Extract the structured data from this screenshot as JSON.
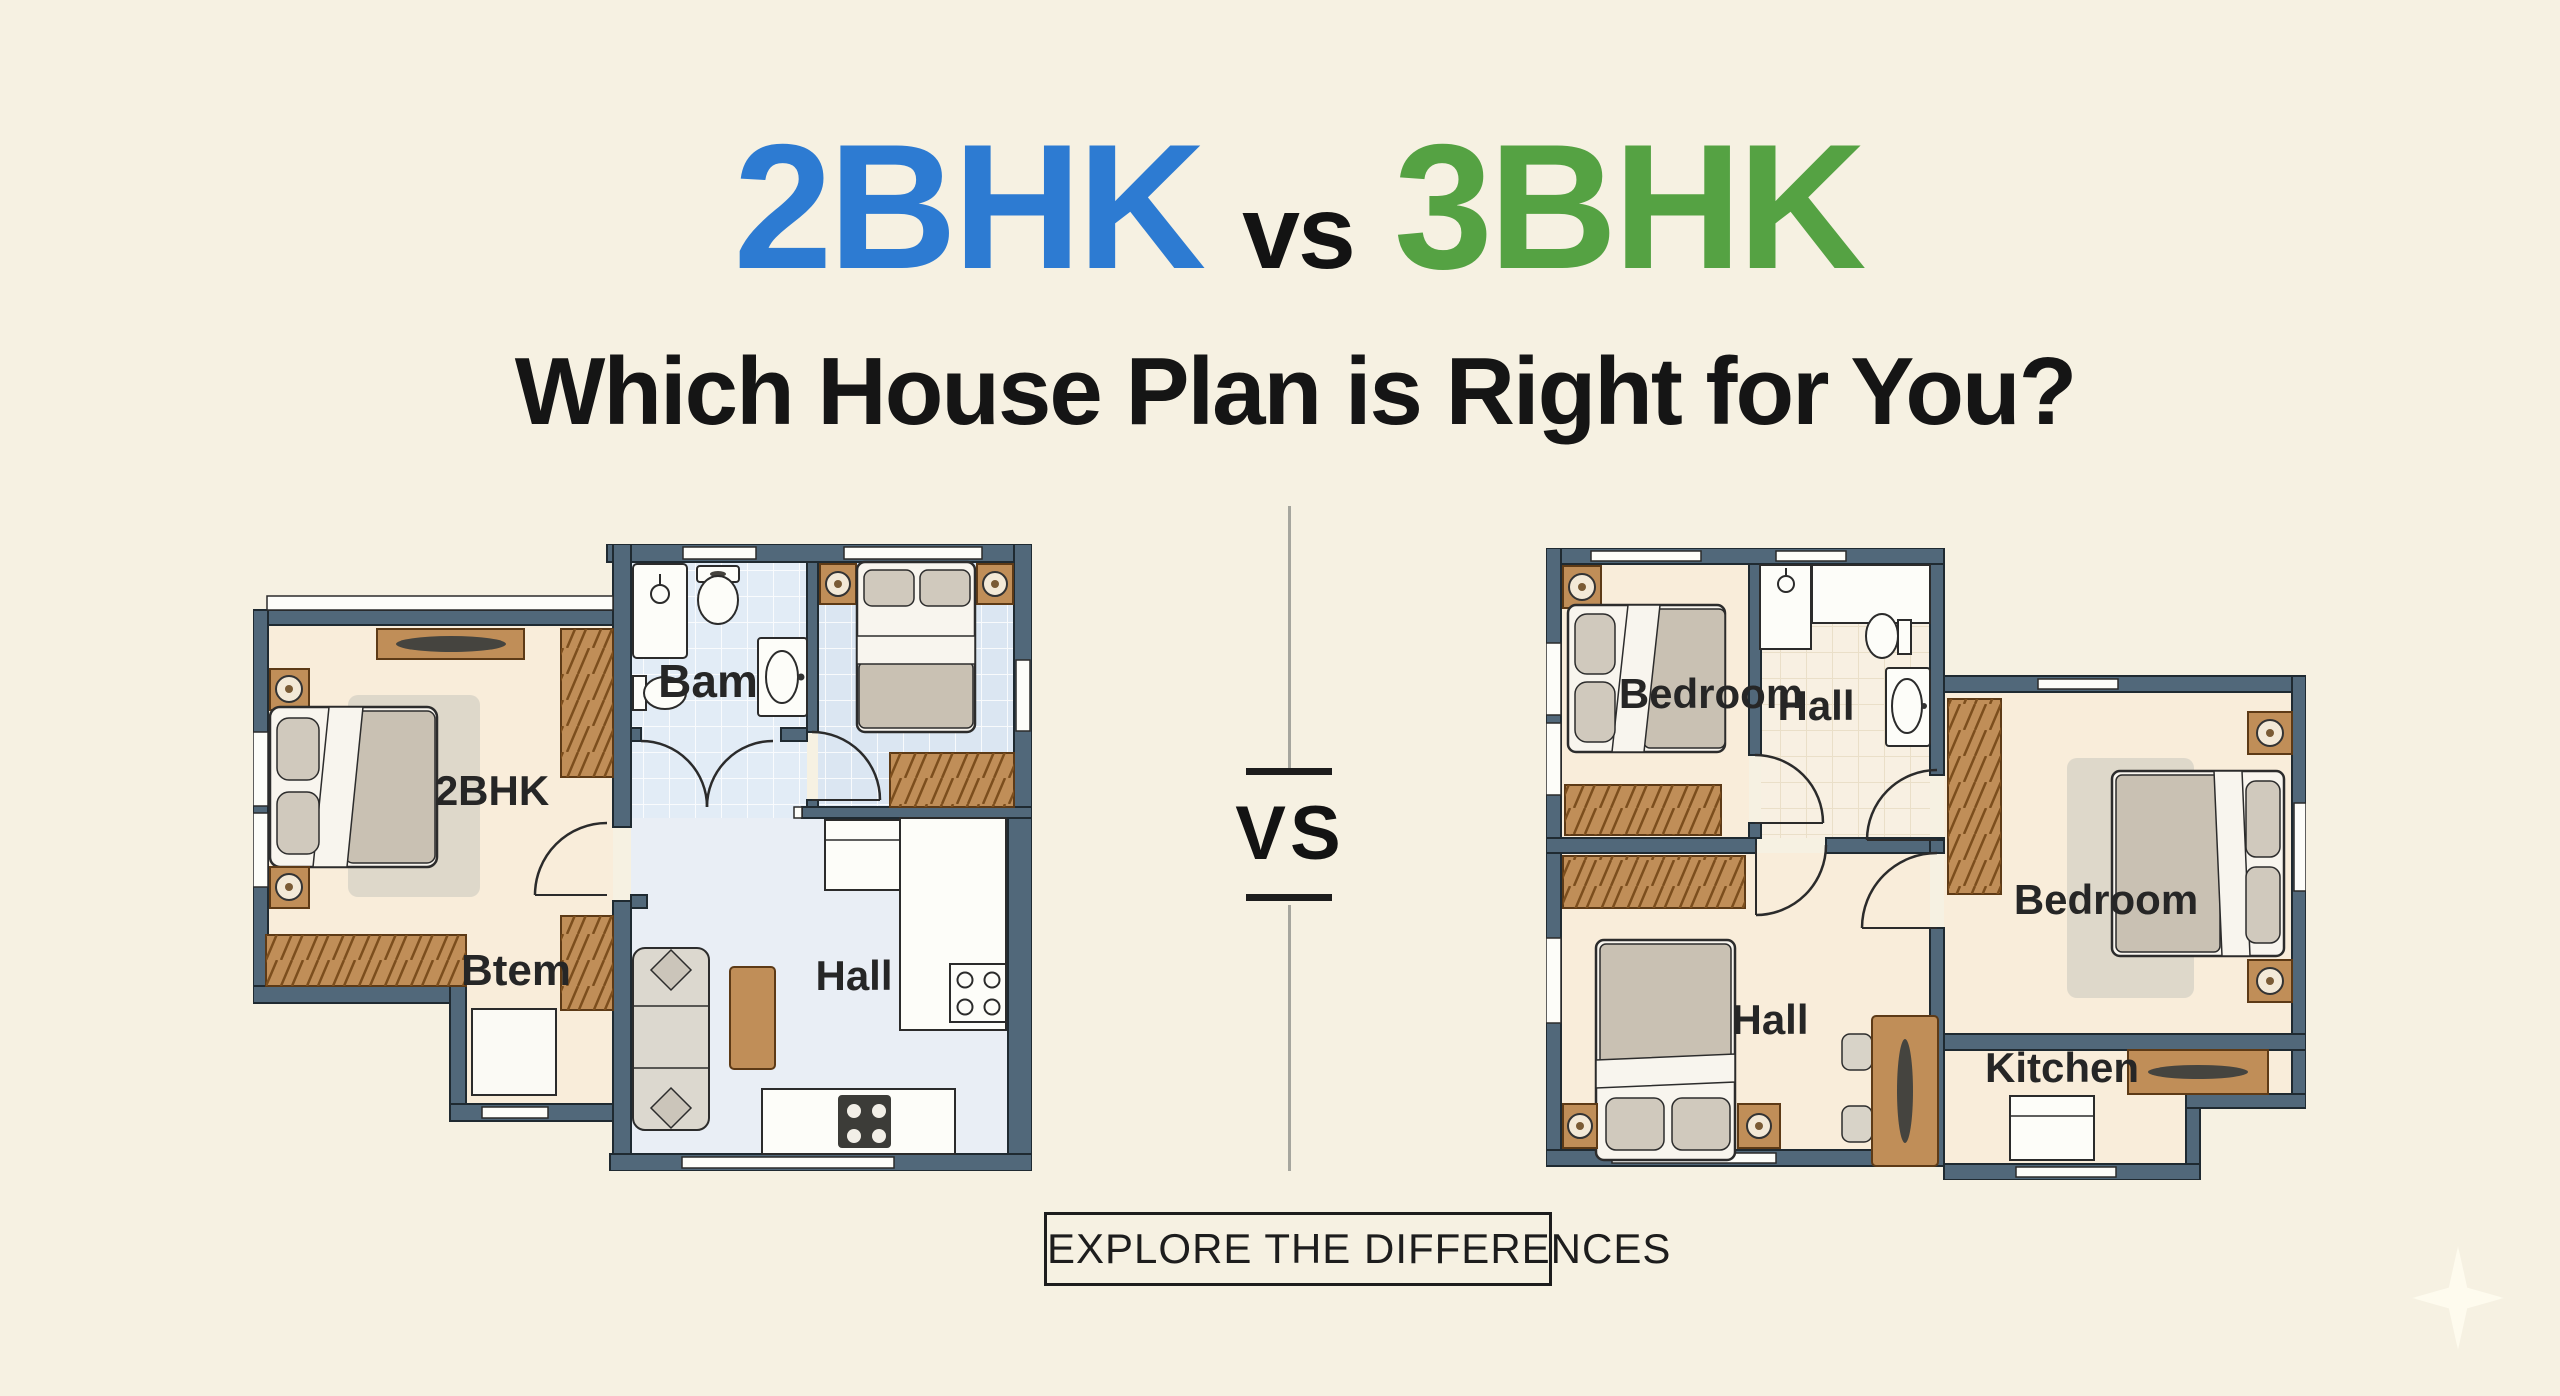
{
  "header": {
    "title_left": "2BHK",
    "title_vs": "vs",
    "title_right": "3BHK",
    "subtitle": "Which House Plan is Right for You?"
  },
  "divider": {
    "vs_label": "VS"
  },
  "left_plan": {
    "name": "2BHK floor plan",
    "labels": {
      "bath": "Bam",
      "bedroom": "2BHK",
      "bedroom2": "Btem",
      "hall": "Hall"
    }
  },
  "right_plan": {
    "name": "3BHK floor plan",
    "labels": {
      "bedroom1": "Bedroom",
      "bath": "Hall",
      "bedroom2": "Bedroom",
      "hall": "Hall",
      "kitchen": "Kitchen"
    }
  },
  "cta": {
    "label": "EXPLORE THE DIFFERENCES"
  },
  "colors": {
    "background": "#f6f1e2",
    "title_blue": "#2d7bd2",
    "title_green": "#55a243",
    "text_black": "#151515",
    "wall": "#51687a",
    "wood": "#c08e58",
    "floor_cream": "#f9edda",
    "floor_blue": "#dfe9f3",
    "bed_gray": "#c9c1b3"
  }
}
